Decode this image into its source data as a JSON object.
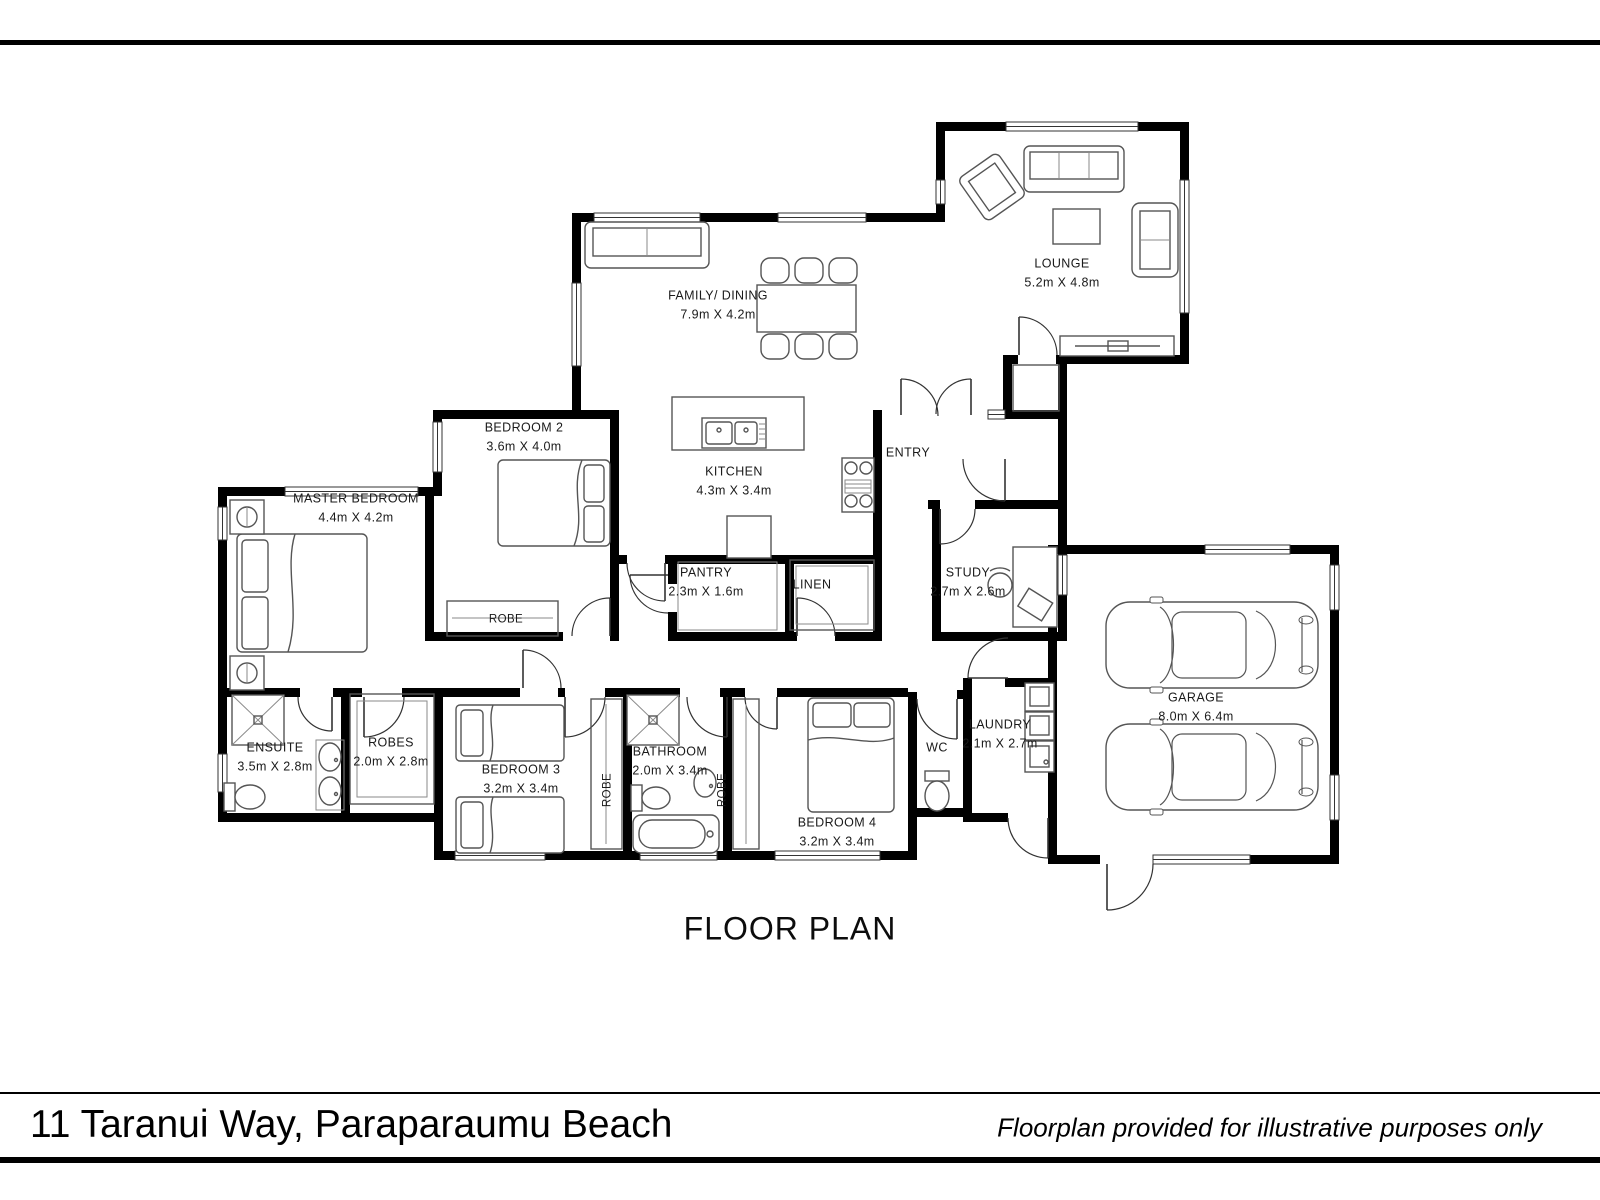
{
  "page": {
    "plan_title": "FLOOR PLAN",
    "footer": {
      "address": "11 Taranui Way, Paraparaumu Beach",
      "disclaimer": "Floorplan provided for illustrative purposes only"
    }
  },
  "colors": {
    "walls": "#000000",
    "furniture_lines": "#555555",
    "text": "#111111"
  },
  "rooms": {
    "lounge": {
      "name": "LOUNGE",
      "dims": "5.2m X 4.8m"
    },
    "family_dining": {
      "name": "FAMILY/ DINING",
      "dims": "7.9m X 4.2m"
    },
    "kitchen": {
      "name": "KITCHEN",
      "dims": "4.3m X 3.4m"
    },
    "entry": {
      "name": "ENTRY"
    },
    "bedroom2": {
      "name": "BEDROOM 2",
      "dims": "3.6m X 4.0m"
    },
    "master_bedroom": {
      "name": "MASTER BEDROOM",
      "dims": "4.4m X 4.2m"
    },
    "pantry": {
      "name": "PANTRY",
      "dims": "2.3m X 1.6m"
    },
    "linen": {
      "name": "LINEN"
    },
    "study": {
      "name": "STUDY",
      "dims": "2.7m X 2.6m"
    },
    "garage": {
      "name": "GARAGE",
      "dims": "8.0m X 6.4m"
    },
    "ensuite": {
      "name": "ENSUITE",
      "dims": "3.5m X 2.8m"
    },
    "robes": {
      "name": "ROBES",
      "dims": "2.0m X 2.8m"
    },
    "bedroom3": {
      "name": "BEDROOM 3",
      "dims": "3.2m X 3.4m"
    },
    "bathroom": {
      "name": "BATHROOM",
      "dims": "2.0m X 3.4m"
    },
    "bedroom4": {
      "name": "BEDROOM 4",
      "dims": "3.2m X 3.4m"
    },
    "wc": {
      "name": "WC"
    },
    "laundry": {
      "name": "LAUNDRY",
      "dims": "2.1m X 2.7m"
    },
    "robe_bedroom2": {
      "name": "ROBE"
    },
    "robe_left": {
      "name": "ROBE"
    },
    "robe_right": {
      "name": "ROBE"
    }
  }
}
